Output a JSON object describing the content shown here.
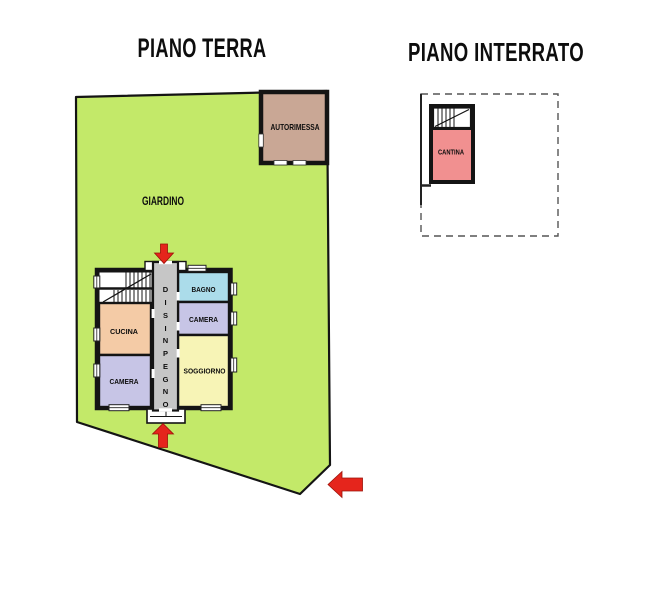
{
  "titles": {
    "ground_floor": "PIANO TERRA",
    "basement": "PIANO INTERRATO"
  },
  "ground_floor": {
    "garden_label": "GIARDINO",
    "garage_label": "AUTORIMESSA",
    "rooms": {
      "kitchen": "CUCINA",
      "bedroom_left": "CAMERA",
      "bathroom": "BAGNO",
      "bedroom_right": "CAMERA",
      "living_room": "SOGGIORNO",
      "hallway": "DISINPEGNO"
    },
    "hallway_letters": [
      "D",
      "I",
      "S",
      "I",
      "N",
      "P",
      "E",
      "G",
      "N",
      "O"
    ]
  },
  "basement": {
    "cellar_label": "CANTINA"
  },
  "colors": {
    "garden": "#c3e969",
    "garage": "#c9a795",
    "kitchen": "#f4cba6",
    "bedroom": "#c7c5e6",
    "bathroom": "#abdcea",
    "living_room": "#f7f4b6",
    "hallway": "#c6c6c6",
    "cellar": "#f19090",
    "arrow": "#e5251c",
    "wall": "#141414"
  }
}
